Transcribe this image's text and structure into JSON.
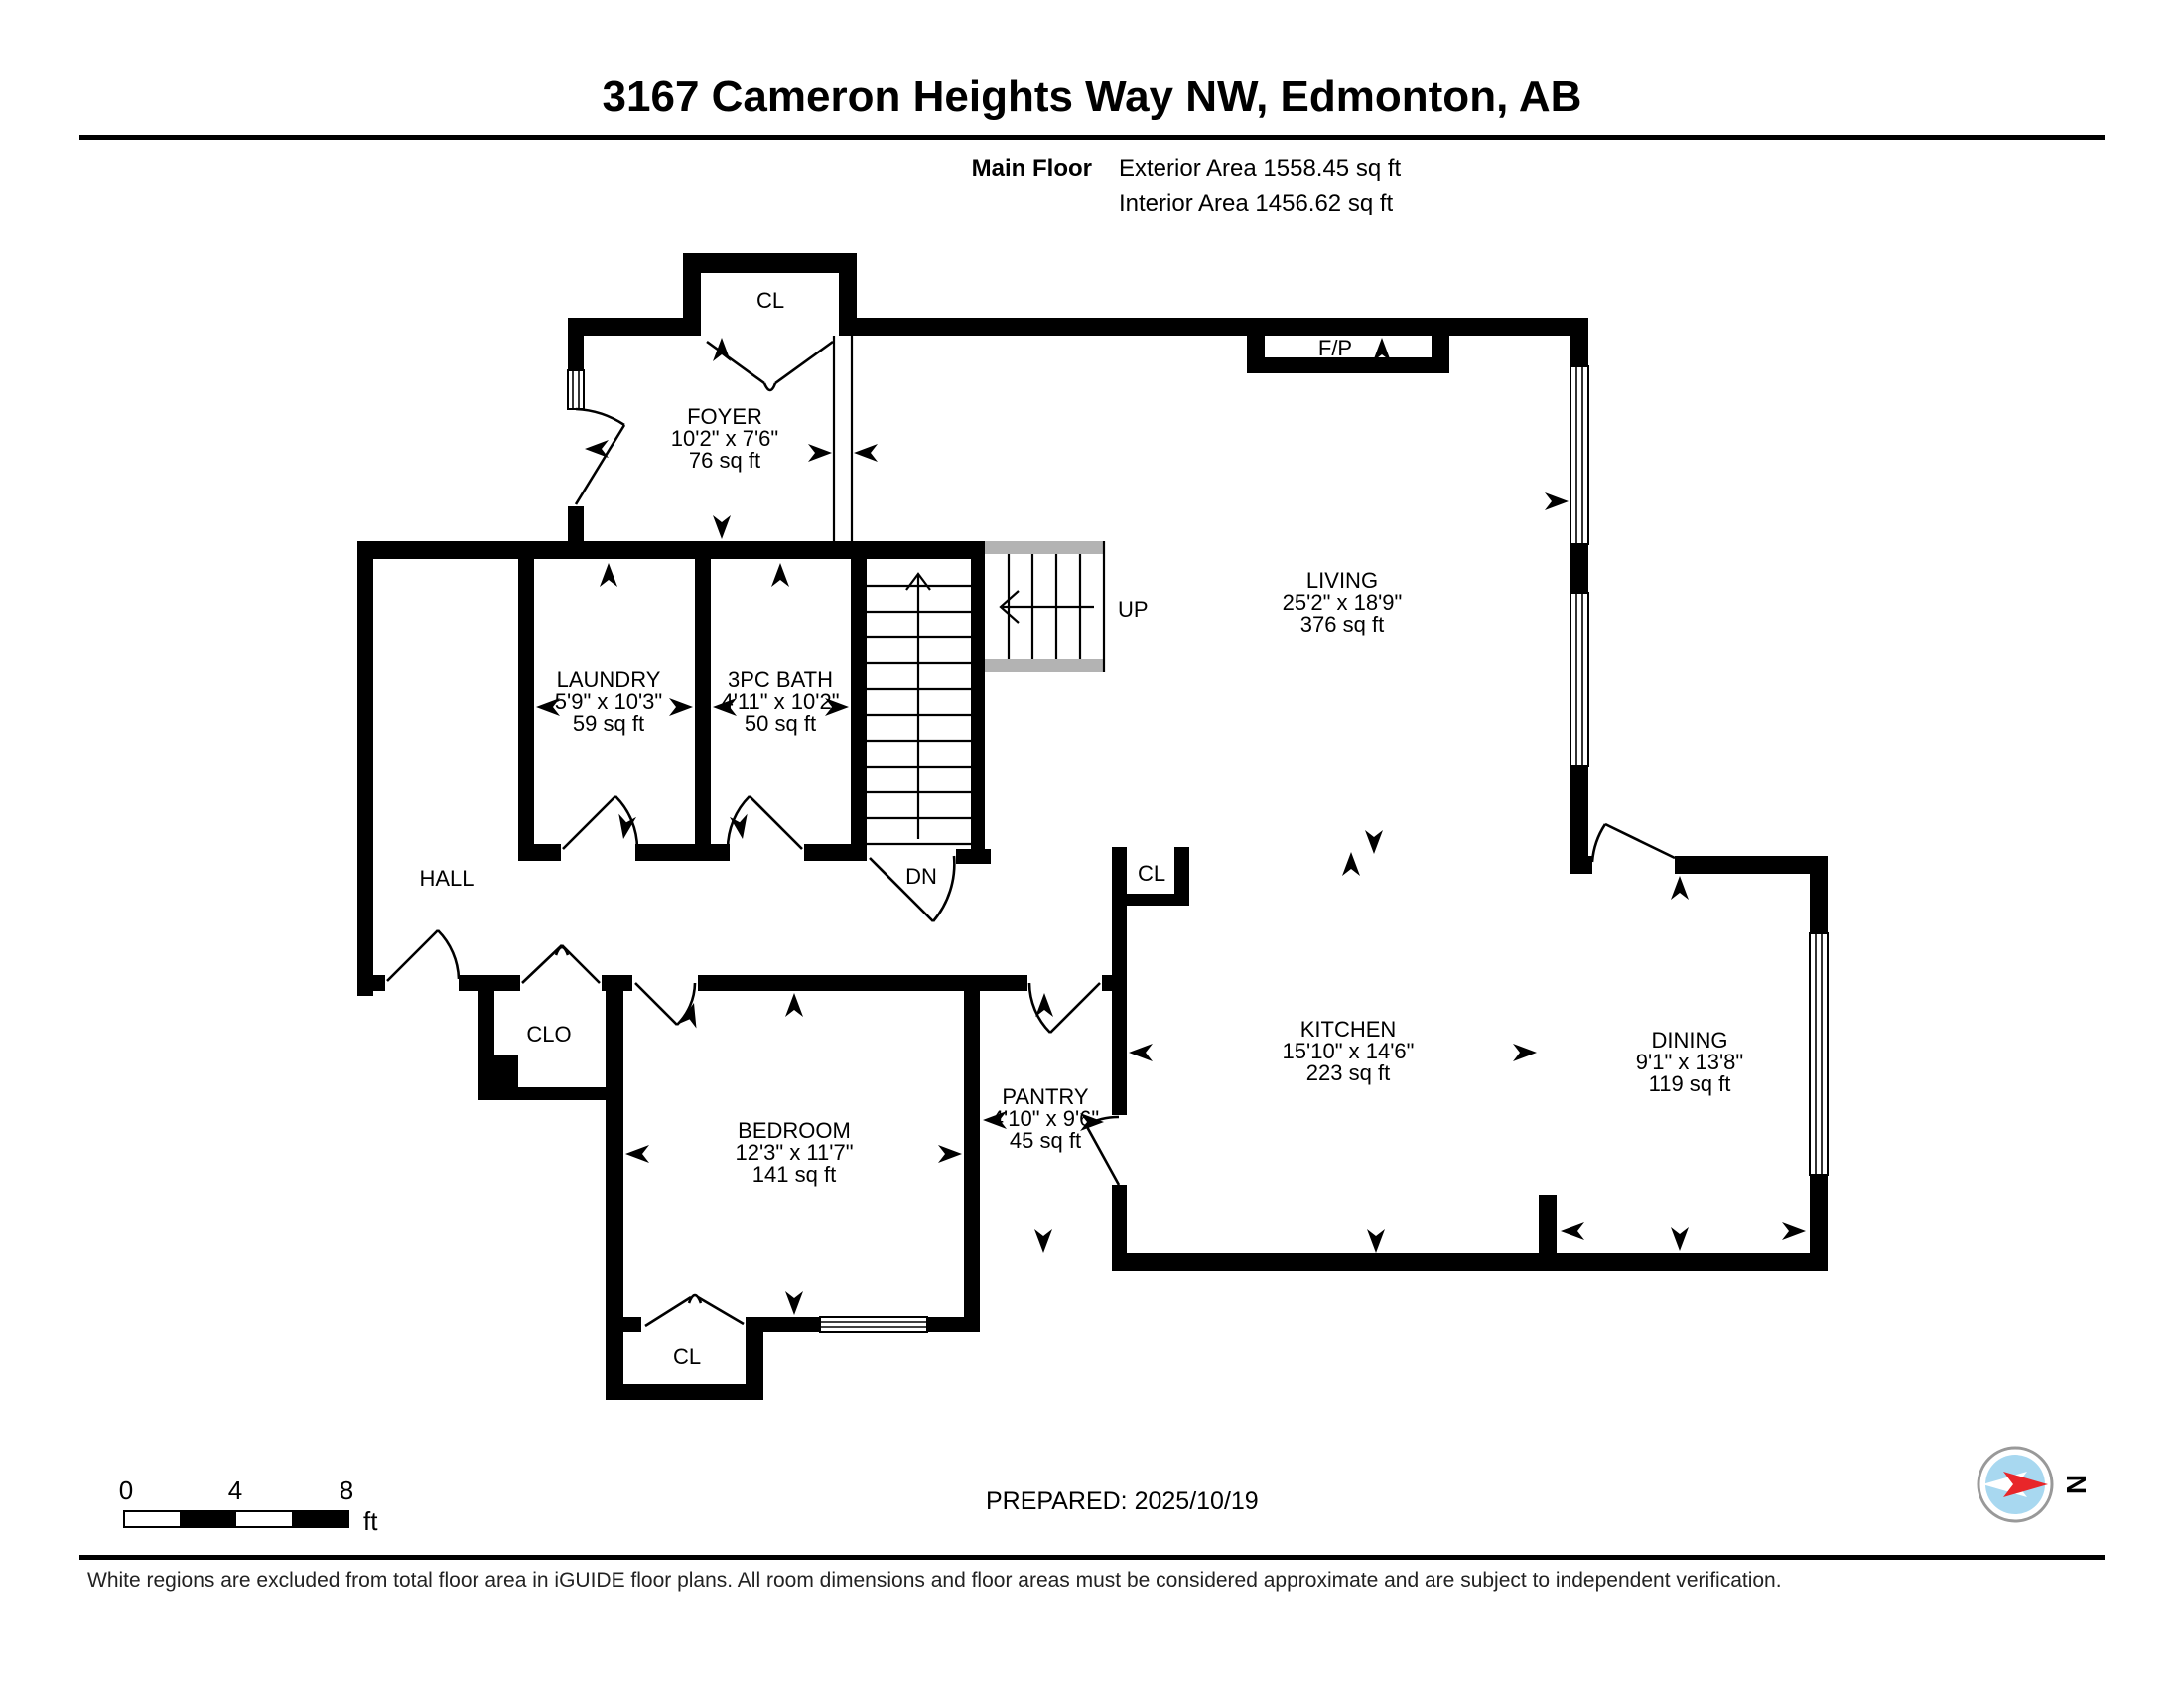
{
  "header": {
    "title": "3167 Cameron Heights Way NW, Edmonton, AB",
    "floor_label": "Main Floor",
    "exterior_area": "Exterior Area 1558.45 sq ft",
    "interior_area": "Interior Area 1456.62 sq ft"
  },
  "rooms": [
    {
      "id": "foyer",
      "name": "FOYER",
      "dims": "10'2\" x 7'6\"",
      "area": "76 sq ft"
    },
    {
      "id": "living",
      "name": "LIVING",
      "dims": "25'2\" x 18'9\"",
      "area": "376 sq ft"
    },
    {
      "id": "laundry",
      "name": "LAUNDRY",
      "dims": "5'9\" x 10'3\"",
      "area": "59 sq ft"
    },
    {
      "id": "bath",
      "name": "3PC BATH",
      "dims": "4'11\" x 10'2\"",
      "area": "50 sq ft"
    },
    {
      "id": "kitchen",
      "name": "KITCHEN",
      "dims": "15'10\" x 14'6\"",
      "area": "223 sq ft"
    },
    {
      "id": "dining",
      "name": "DINING",
      "dims": "9'1\" x 13'8\"",
      "area": "119 sq ft"
    },
    {
      "id": "bedroom",
      "name": "BEDROOM",
      "dims": "12'3\" x 11'7\"",
      "area": "141 sq ft"
    },
    {
      "id": "pantry",
      "name": "PANTRY",
      "dims": "4'10\" x 9'6\"",
      "area": "45 sq ft"
    }
  ],
  "labels": {
    "hall": "HALL",
    "closet_foyer": "CL",
    "closet_kitchen": "CL",
    "closet_bedroom": "CL",
    "closet_hall": "CLO",
    "fireplace": "F/P",
    "stairs_up": "UP",
    "stairs_down": "DN"
  },
  "scale_bar": {
    "t0": "0",
    "t4": "4",
    "t8": "8",
    "unit": "ft"
  },
  "prepared": "PREPARED: 2025/10/19",
  "compass": {
    "north": "N"
  },
  "footer": "White regions are excluded from total floor area in iGUIDE floor plans. All room dimensions and floor areas must be considered approximate and are subject to independent verification."
}
